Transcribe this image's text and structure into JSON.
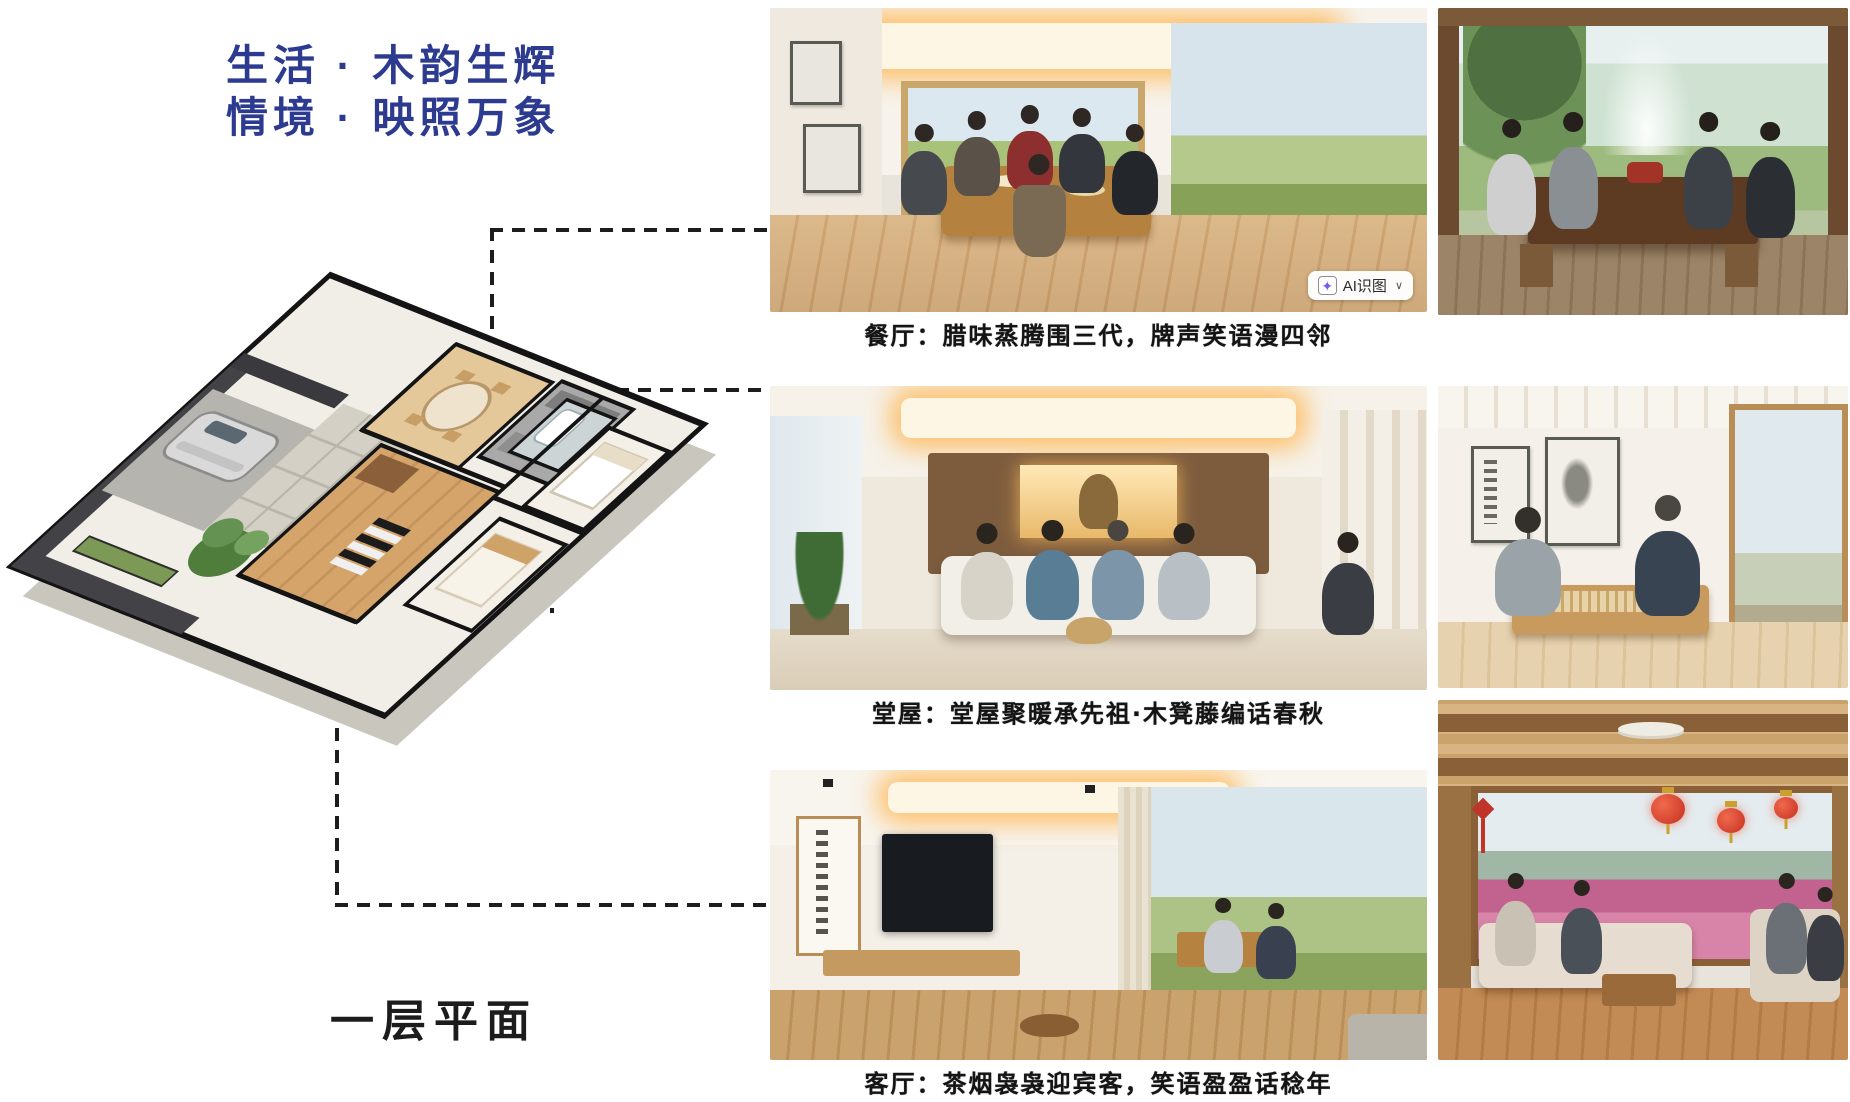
{
  "title": {
    "line1": "生活 · 木韵生辉",
    "line2": "情境 · 映照万象",
    "color": "#2c3a90"
  },
  "floor_plan": {
    "label": "一层平面"
  },
  "gallery": {
    "captions": [
      "餐厅：腊味蒸腾围三代，牌声笑语漫四邻",
      "堂屋：堂屋聚暖承先祖·木凳藤编话春秋",
      "客厅：茶烟袅袅迎宾客，笑语盈盈话稔年"
    ]
  },
  "badge": {
    "icon_glyph": "✦",
    "label": "AI识图",
    "chevron": "∨"
  },
  "colors": {
    "title_blue": "#2c3a90",
    "caption_black": "#141414",
    "dash_line": "#1d1d1d",
    "badge_icon_purple": "#7a55f6"
  }
}
